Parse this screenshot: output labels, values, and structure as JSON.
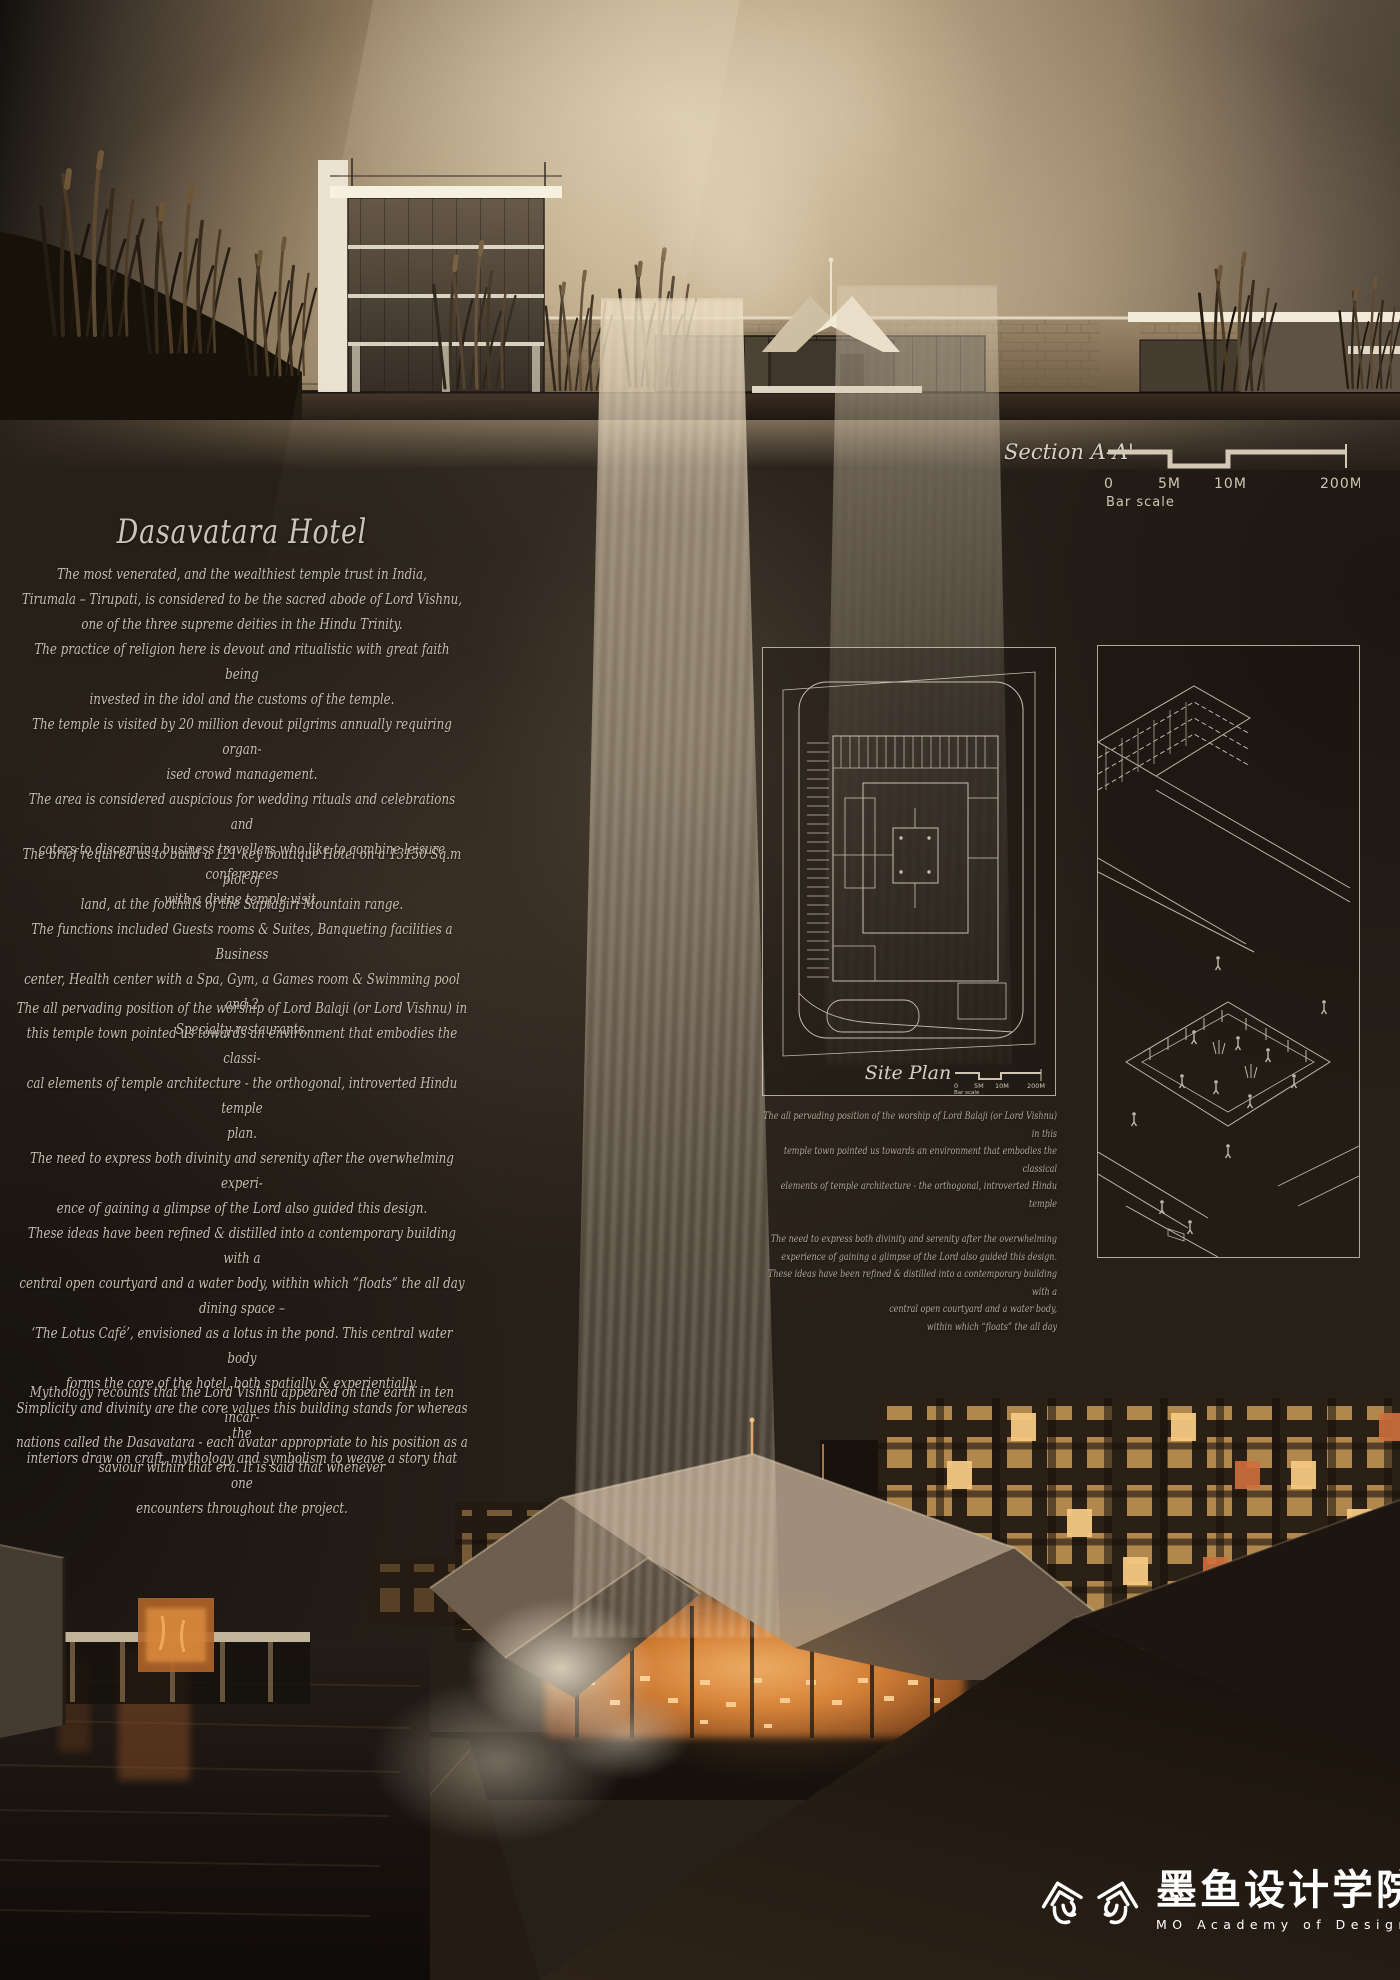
{
  "colors": {
    "sky_warm": "#b7a282",
    "background": "#272019",
    "body_text": "#c6bdb0",
    "line_art": "#d6cec0",
    "glow_orange": "#e08a3c",
    "logo_white": "#ffffff"
  },
  "title": "Dasavatara Hotel",
  "intro": {
    "p1": [
      "The most venerated, and the wealthiest temple trust in India,",
      "Tirumala – Tirupati, is considered to be the sacred abode of Lord Vishnu,",
      "one of the three supreme deities in the Hindu Trinity.",
      "The practice of religion here is devout and ritualistic with great faith being",
      "invested in the idol and the customs of the temple.",
      "The temple is visited by 20 million devout pilgrims annually requiring organ-",
      "ised crowd management.",
      "The area is considered auspicious for wedding rituals and celebrations and",
      "caters to discerning business travellers who like to combine leisure conferences",
      "with a divine temple visit."
    ],
    "p2": [
      "The brief required us to build a 121 key boutique Hotel on a 13150 Sq.m plot of",
      "land, at the foothills of the Saptagiri Mountain range.",
      "The functions included Guests rooms & Suites, Banqueting facilities a Business",
      "center, Health center with a Spa, Gym, a Games room & Swimming pool and 2",
      "Specialty restaurants."
    ],
    "p3": [
      "The all pervading position of the worship of Lord Balaji (or Lord Vishnu) in",
      "this temple town pointed us towards an environment that embodies the classi-",
      "cal elements of temple architecture - the orthogonal, introverted Hindu temple",
      "plan.",
      "The need to express both divinity and serenity after the overwhelming experi-",
      "ence of gaining a glimpse of the Lord also guided this design.",
      "These ideas have been refined & distilled into a contemporary building with a",
      "central open courtyard and a water body, within which “floats” the all day",
      "dining space –",
      "‘The Lotus Café’, envisioned as a lotus in the pond. This central water body",
      "forms the core of the hotel, both spatially & experientially.",
      "Simplicity and divinity are the core values this building stands for whereas the",
      "interiors draw on craft, mythology and symbolism to weave a story that one",
      "encounters throughout the project."
    ],
    "p4": [
      "Mythology recounts that the Lord Vishnu appeared on the earth in ten incar-",
      "nations called the Dasavatara - each avatar appropriate to his position as a",
      "saviour within that era. It is said that whenever"
    ]
  },
  "section": {
    "label": "Section A-A'",
    "scale": {
      "zero": "0",
      "five": "5M",
      "ten": "10M",
      "max": "200M",
      "caption": "Bar scale"
    }
  },
  "site_plan": {
    "label": "Site Plan",
    "caption_p1": [
      "The all pervading position of the worship of Lord Balaji (or Lord Vishnu) in this",
      "temple town pointed us towards an environment that embodies the classical",
      "elements of temple architecture - the orthogonal, introverted Hindu temple"
    ],
    "caption_p2": [
      "The need to express both divinity and serenity after the overwhelming",
      "experience of gaining a glimpse of the Lord also guided this design.",
      "These ideas have been refined & distilled into a contemporary building with a",
      "central open courtyard and a water body,",
      "within which “floats” the all day"
    ]
  },
  "logo": {
    "cn": "墨鱼设计学院",
    "en": "MO Academy of Design"
  }
}
